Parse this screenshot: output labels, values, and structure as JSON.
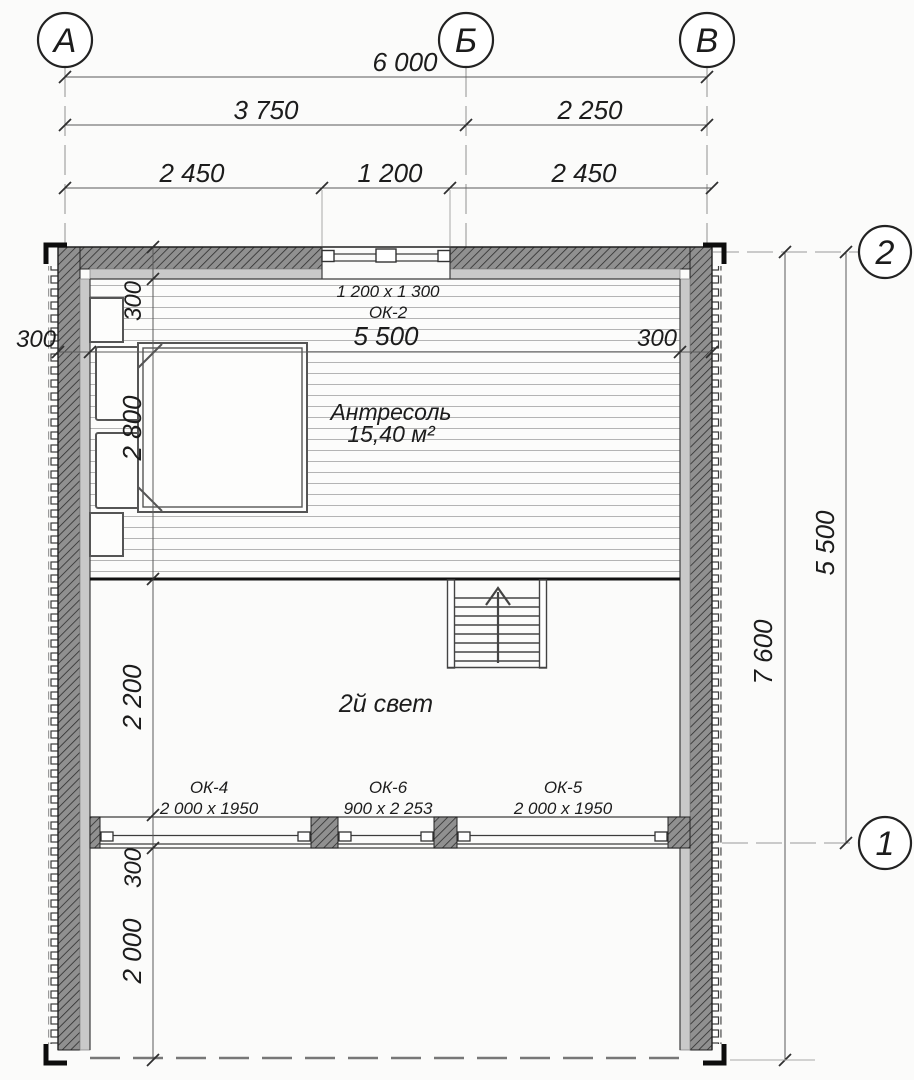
{
  "plan": {
    "axes": {
      "col_a": "А",
      "col_b": "Б",
      "col_c": "В",
      "row_2": "2",
      "row_1": "1"
    },
    "dims": {
      "overall_width": "6 000",
      "span_ab": "3 750",
      "span_bv": "2 250",
      "seg_left": "2 450",
      "seg_mid": "1 200",
      "seg_right": "2 450",
      "wall_left": "300",
      "room_width": "5 500",
      "wall_right": "300",
      "left_chain": [
        "300",
        "2 800",
        "2 200",
        "300",
        "2 000"
      ],
      "right_inner": "5 500",
      "right_overall": "7 600"
    },
    "rooms": {
      "mezzanine_name": "Антресоль",
      "mezzanine_area": "15,40 м²",
      "void_name": "2й свет"
    },
    "windows": {
      "ok2_tag": "ОК-2",
      "ok2_size": "1 200 x 1 300",
      "ok4_tag": "ОК-4",
      "ok4_size": "2 000 x 1950",
      "ok6_tag": "ОК-6",
      "ok6_size": "900 x 2 253",
      "ok5_tag": "ОК-5",
      "ok5_size": "2 000 x 1950"
    }
  }
}
